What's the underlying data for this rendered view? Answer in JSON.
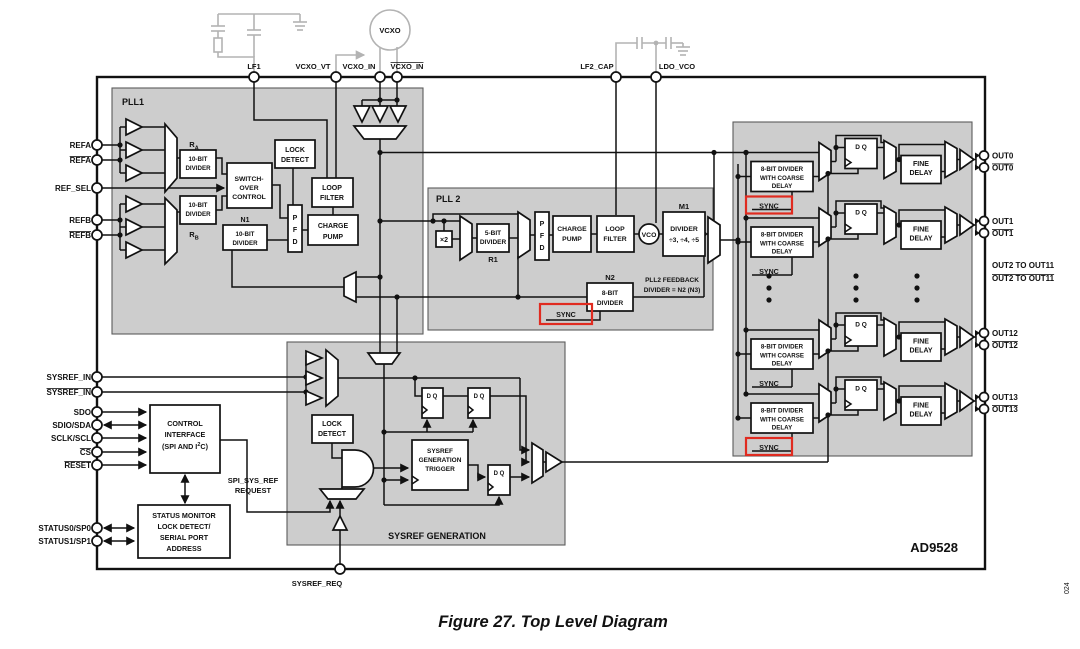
{
  "figure": {
    "caption": "Figure 27. Top Level Diagram",
    "chip_label": "AD9528",
    "watermark": "024"
  },
  "colors": {
    "block_fill": "#cdcdcd",
    "highlight_red": "#e02b20",
    "external_gray": "#b3b3b3",
    "line": "#111111"
  },
  "pins": {
    "refa": "REFA",
    "refa_b": "REFA",
    "ref_sel": "REF_SEL",
    "refb": "REFB",
    "refb_b": "REFB",
    "sysref_in": "SYSREF_IN",
    "sysref_in_b": "SYSREF_IN",
    "sdo": "SDO",
    "sdio": "SDIO/SDA",
    "sclk": "SCLK/SCL",
    "cs": "CS",
    "reset": "RESET",
    "status0": "STATUS0/SP0",
    "status1": "STATUS1/SP1",
    "lf1": "LF1",
    "vcxo_vt": "VCXO_VT",
    "vcxo_in": "VCXO_IN",
    "vcxo_in_b": "VCXO_IN",
    "lf2_cap": "LF2_CAP",
    "ldo_vco": "LDO_VCO",
    "sysref_req": "SYSREF_REQ"
  },
  "external": {
    "vcxo": "VCXO"
  },
  "pll1": {
    "title": "PLL1",
    "r": "R",
    "ra_sub": "A",
    "rb_sub": "B",
    "div10": [
      "10-BIT",
      "DIVIDER"
    ],
    "switchover": [
      "SWITCH-",
      "OVER",
      "CONTROL"
    ],
    "lock": [
      "LOCK",
      "DETECT"
    ],
    "loop": [
      "LOOP",
      "FILTER"
    ],
    "pfd": [
      "P",
      "F",
      "D"
    ],
    "cp": [
      "CHARGE",
      "PUMP"
    ],
    "n1": "N1"
  },
  "pll2": {
    "title": "PLL 2",
    "x2": "×2",
    "div5": [
      "5-BIT",
      "DIVIDER"
    ],
    "r1": "R1",
    "pfd": [
      "P",
      "F",
      "D"
    ],
    "cp": [
      "CHARGE",
      "PUMP"
    ],
    "loop": [
      "LOOP",
      "FILTER"
    ],
    "vco": "VCO",
    "m1": "M1",
    "m1_div": [
      "DIVIDER",
      "÷3, ÷4, ÷5"
    ],
    "n2": "N2",
    "div8": [
      "8-BIT",
      "DIVIDER"
    ],
    "fb": [
      "PLL2 FEEDBACK",
      "DIVIDER = N2 (N3)"
    ],
    "sync": "SYNC"
  },
  "sysref": {
    "title": "SYSREF GENERATION",
    "lock": [
      "LOCK",
      "DETECT"
    ],
    "trigger": [
      "SYSREF",
      "GENERATION",
      "TRIGGER"
    ],
    "dq": "D Q",
    "spi_req": [
      "SPI_SYS_REF",
      "REQUEST"
    ]
  },
  "control": {
    "iface": [
      "CONTROL",
      "INTERFACE"
    ],
    "iface_pre": "(SPI AND I",
    "iface_sup": "2",
    "iface_post": "C)",
    "status": [
      "STATUS MONITOR",
      "LOCK DETECT/",
      "SERIAL PORT",
      "ADDRESS"
    ]
  },
  "channels": {
    "divider": [
      "8-BIT DIVIDER",
      "WITH COARSE",
      "DELAY"
    ],
    "sync": "SYNC",
    "dq": "D Q",
    "fine": [
      "FINE",
      "DELAY"
    ],
    "rows": [
      {
        "out": "OUT0",
        "out_b": "OUT0"
      },
      {
        "out": "OUT1",
        "out_b": "OUT1"
      },
      {
        "out": "OUT12",
        "out_b": "OUT12"
      },
      {
        "out": "OUT13",
        "out_b": "OUT13"
      }
    ],
    "hidden": [
      "OUT2 TO OUT11",
      "OUT2 TO OUT11"
    ]
  }
}
